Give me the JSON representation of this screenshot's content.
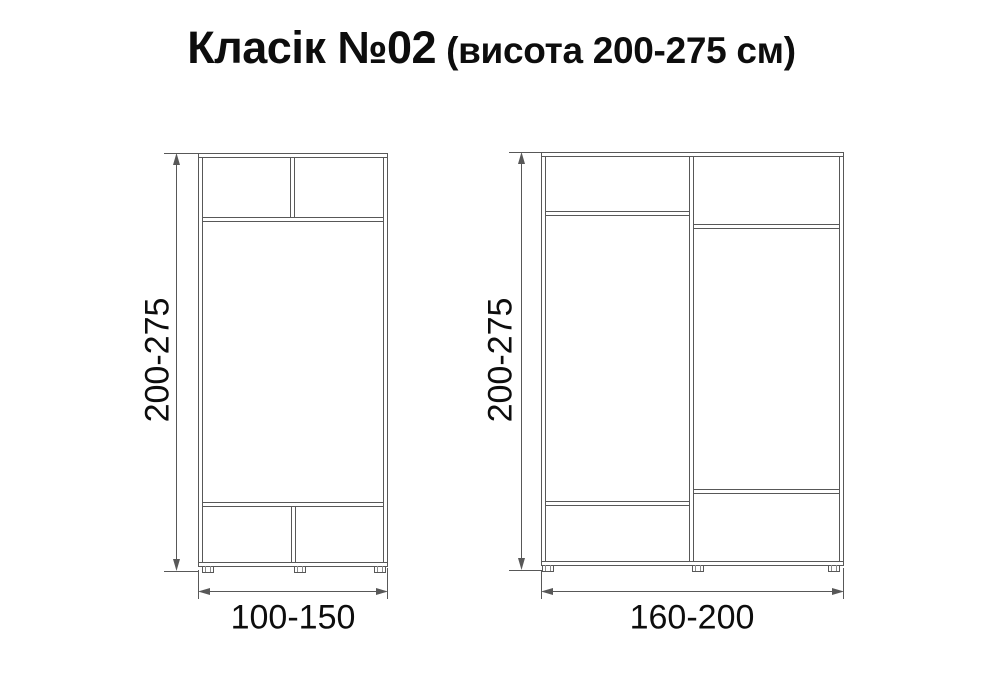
{
  "title": {
    "main": "Класік №02",
    "sub": "(висота 200-275 см)"
  },
  "wardrobes": [
    {
      "name": "small-wardrobe",
      "height_label": "200-275",
      "width_label": "100-150"
    },
    {
      "name": "large-wardrobe",
      "height_label": "200-275",
      "width_label": "160-200"
    }
  ],
  "colors": {
    "line": "#585858",
    "text": "#0d0d0d",
    "background": "#ffffff"
  }
}
